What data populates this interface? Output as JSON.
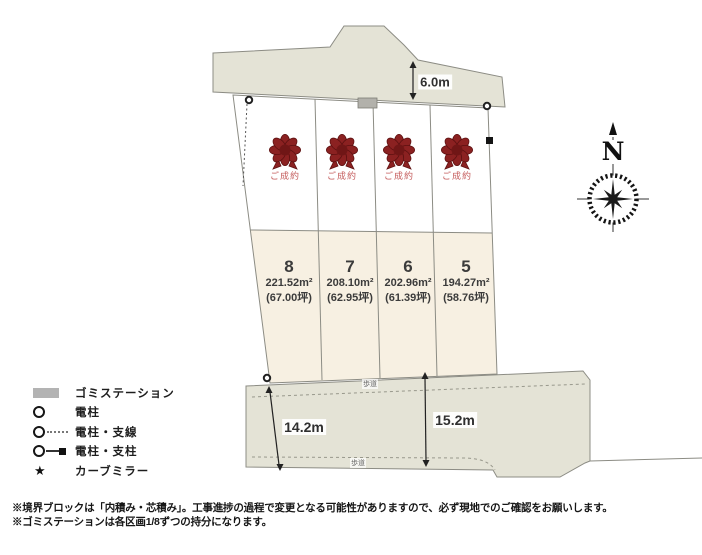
{
  "map": {
    "compass_label": "N",
    "road_width_label": "6.0m",
    "dim_left_label": "14.2m",
    "dim_right_label": "15.2m",
    "sidewalk_top_label": "歩道",
    "sidewalk_bottom_label": "歩道",
    "sold_label": "ご成約",
    "plots": [
      {
        "number": "8",
        "area_m2": "221.52m²",
        "area_tsubo": "(67.00坪)"
      },
      {
        "number": "7",
        "area_m2": "208.10m²",
        "area_tsubo": "(62.95坪)"
      },
      {
        "number": "6",
        "area_m2": "202.96m²",
        "area_tsubo": "(61.39坪)"
      },
      {
        "number": "5",
        "area_m2": "194.27m²",
        "area_tsubo": "(58.76坪)"
      }
    ]
  },
  "legend": {
    "items": [
      {
        "icon": "garbage-station-swatch",
        "label": "ゴミステーション"
      },
      {
        "icon": "utility-pole",
        "label": "電柱"
      },
      {
        "icon": "utility-pole-guywire",
        "label": "電柱・支線"
      },
      {
        "icon": "utility-pole-support",
        "label": "電柱・支柱"
      },
      {
        "icon": "curve-mirror-star",
        "label": "カーブミラー"
      }
    ]
  },
  "notes": {
    "line1": "※境界ブロックは「内積み・芯積み」。工事進捗の過程で変更となる可能性がありますので、必ず現地でのご確認をお願いします。",
    "line2": "※ゴミステーションは各区画1/8ずつの持分になります。"
  },
  "colors": {
    "road_fill": "#e4e3d6",
    "plot_fill": "#f7f0e2",
    "outline": "#8c8c84",
    "ribbon": "#8b2121",
    "sold_text": "#c45b5b",
    "legend_swatch": "#b3b3b3"
  }
}
